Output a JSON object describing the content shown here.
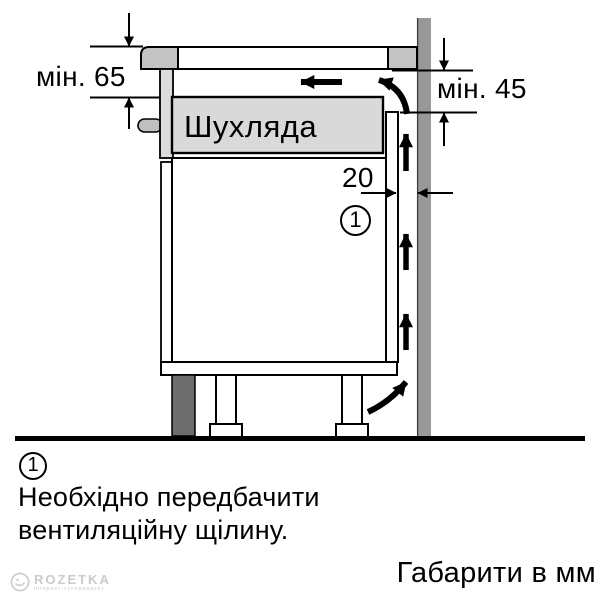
{
  "figure": {
    "type": "hob-installation-side-view",
    "drawer_label": "Шухляда",
    "dimensions": {
      "min_top_clearance": "мін. 65",
      "min_back_outlet": "мін. 45",
      "vent_gap": "20"
    },
    "callout_number": "1"
  },
  "footnote": {
    "marker": "1",
    "line1": "Необхідно передбачити",
    "line2": "вентиляційну щілину."
  },
  "units_note": "Габарити в мм",
  "watermark": {
    "brand": "ROZETKA",
    "tagline": "інтернет-супермаркет"
  },
  "colors": {
    "outline": "#000000",
    "wall": "#989898",
    "wall_edge": "#3c3c3c",
    "hob_edge": "#c3c3c3",
    "bracket": "#bfbfbf",
    "hob_frame": "#dcdcdc",
    "drawer_fill": "#d9d9d9",
    "plinth": "#6d6d6d",
    "panel_fill": "#ffffff",
    "watermark": "#cbcbcb"
  }
}
